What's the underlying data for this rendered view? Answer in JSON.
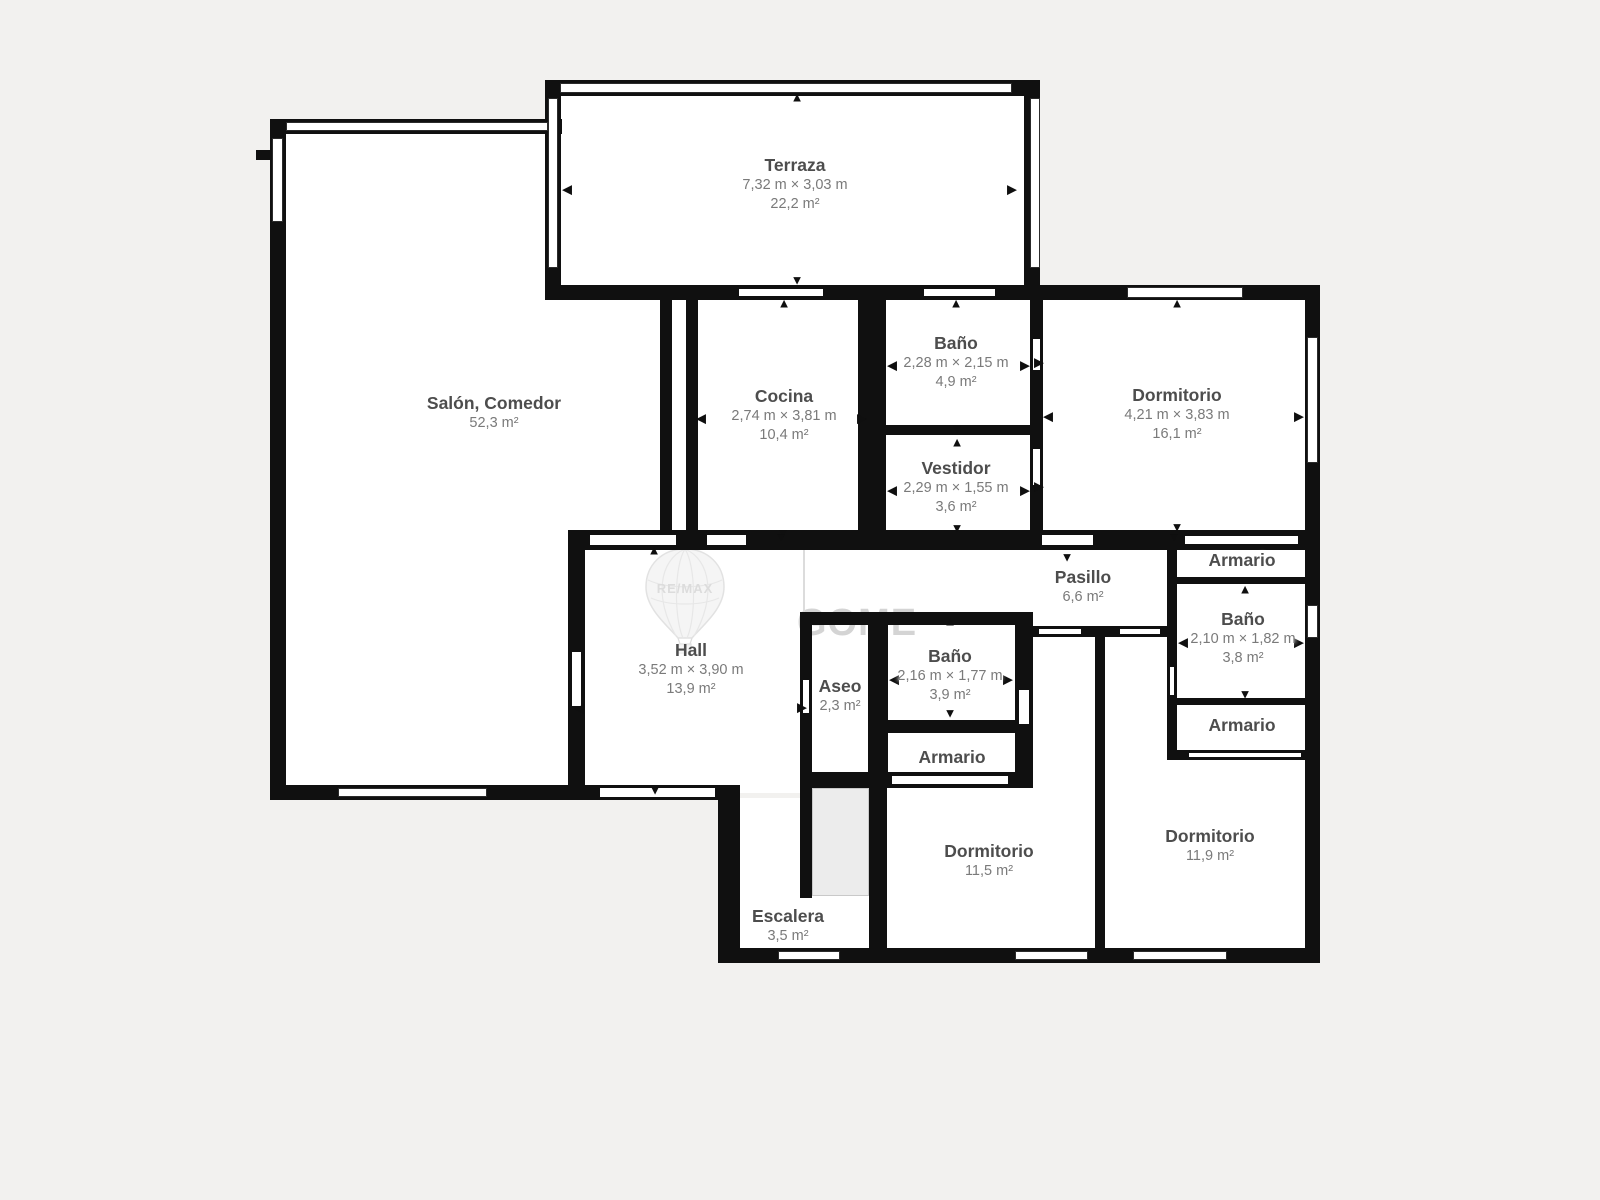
{
  "meta": {
    "background_color": "#f2f1ef",
    "wall_color": "#101010",
    "floor_color": "#ffffff"
  },
  "watermark": {
    "brand": "RE/MAX",
    "text": "GOME",
    "balloon_icon": "hot-air-balloon-icon"
  },
  "icons": {
    "up": "▲",
    "down": "▼",
    "left": "◀",
    "right": "▶"
  },
  "rooms": [
    {
      "id": "terraza",
      "name": "Terraza",
      "dims": "7,32 m × 3,03 m",
      "area": "22,2 m²"
    },
    {
      "id": "salon",
      "name": "Salón, Comedor",
      "dims": "",
      "area": "52,3 m²"
    },
    {
      "id": "cocina",
      "name": "Cocina",
      "dims": "2,74 m × 3,81 m",
      "area": "10,4 m²"
    },
    {
      "id": "bano_top",
      "name": "Baño",
      "dims": "2,28 m × 2,15 m",
      "area": "4,9 m²"
    },
    {
      "id": "vestidor",
      "name": "Vestidor",
      "dims": "2,29 m × 1,55 m",
      "area": "3,6 m²"
    },
    {
      "id": "dorm_ne",
      "name": "Dormitorio",
      "dims": "4,21 m × 3,83 m",
      "area": "16,1 m²"
    },
    {
      "id": "pasillo",
      "name": "Pasillo",
      "dims": "",
      "area": "6,6 m²"
    },
    {
      "id": "hall",
      "name": "Hall",
      "dims": "3,52 m × 3,90 m",
      "area": "13,9 m²"
    },
    {
      "id": "aseo",
      "name": "Aseo",
      "dims": "",
      "area": "2,3 m²"
    },
    {
      "id": "bano_mid",
      "name": "Baño",
      "dims": "2,16 m × 1,77 m",
      "area": "3,9 m²"
    },
    {
      "id": "armario_mid",
      "name": "Armario",
      "dims": "",
      "area": ""
    },
    {
      "id": "armario_e1",
      "name": "Armario",
      "dims": "",
      "area": ""
    },
    {
      "id": "bano_e",
      "name": "Baño",
      "dims": "2,10 m × 1,82 m",
      "area": "3,8 m²"
    },
    {
      "id": "armario_e2",
      "name": "Armario",
      "dims": "",
      "area": ""
    },
    {
      "id": "dorm_sw",
      "name": "Dormitorio",
      "dims": "",
      "area": "11,5 m²"
    },
    {
      "id": "dorm_se",
      "name": "Dormitorio",
      "dims": "",
      "area": "11,9 m²"
    },
    {
      "id": "escalera",
      "name": "Escalera",
      "dims": "",
      "area": "3,5 m²"
    }
  ]
}
